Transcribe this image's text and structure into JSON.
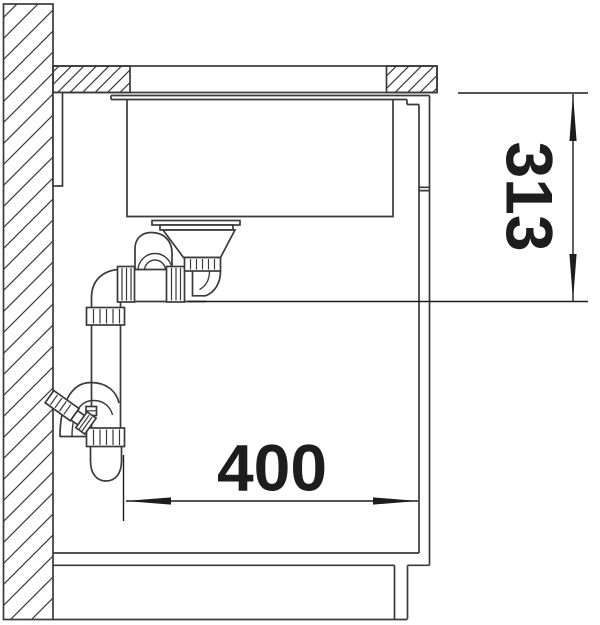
{
  "drawing": {
    "background": "#ffffff",
    "line_color": "#3a3a3a",
    "dim_color": "#1d1d1d",
    "dimensions": {
      "vertical": {
        "label": "313"
      },
      "horizontal": {
        "label": "400"
      }
    }
  }
}
